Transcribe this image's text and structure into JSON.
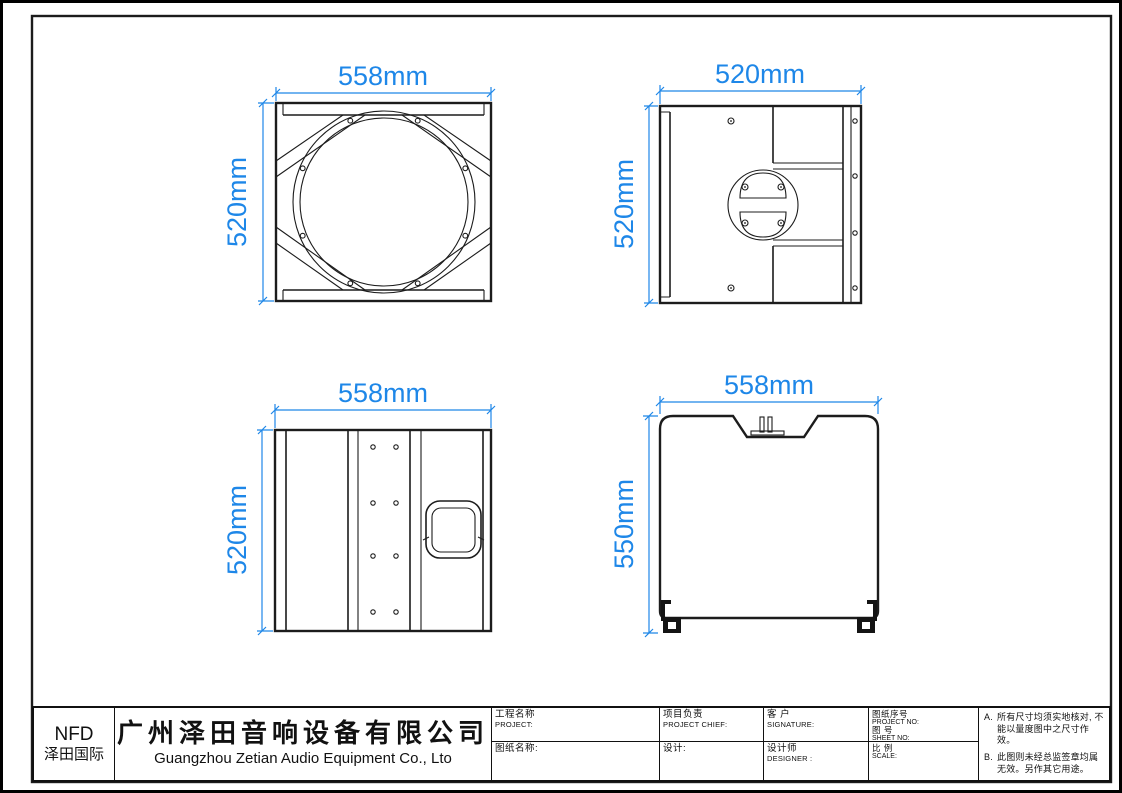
{
  "colors": {
    "dimension_blue": "#1e87e8",
    "line_black": "#1c1c1c",
    "paper": "#ffffff"
  },
  "views": {
    "front": {
      "width_dim": "558mm",
      "height_dim": "520mm"
    },
    "rear": {
      "width_dim": "520mm",
      "height_dim": "520mm"
    },
    "side": {
      "width_dim": "558mm",
      "height_dim": "520mm"
    },
    "profile": {
      "width_dim": "558mm",
      "height_dim": "550mm"
    }
  },
  "title_block": {
    "logo": {
      "brand": "NFD",
      "brand_cn": "泽田国际"
    },
    "company": {
      "name_cn": "广州泽田音响设备有限公司",
      "name_en": "Guangzhou Zetian Audio Equipment Co., Lto"
    },
    "fields": {
      "project_cn": "工程名称",
      "project_en": "PROJECT:",
      "drawing_name_cn": "图纸名称:",
      "chief_cn": "项目负责",
      "chief_en": "PROJECT CHIEF:",
      "design_cn": "设计:",
      "client_cn": "客 户",
      "client_en": "SIGNATURE:",
      "designer_cn": "设计师",
      "designer_en": "DESIGNER :",
      "project_no_cn": "图纸序号",
      "project_no_en": "PROJECT NO:",
      "sheet_no_cn": "图  号",
      "sheet_no_en": "SHEET NO:",
      "scale_cn": "比  例",
      "scale_en": "SCALE:"
    },
    "notes": {
      "a_label": "A.",
      "a_text": "所有尺寸均须实地核对, 不能以量度图中之尺寸作效。",
      "b_label": "B.",
      "b_text": "此图则未经总监签章均属无效。另作其它用途。"
    }
  }
}
